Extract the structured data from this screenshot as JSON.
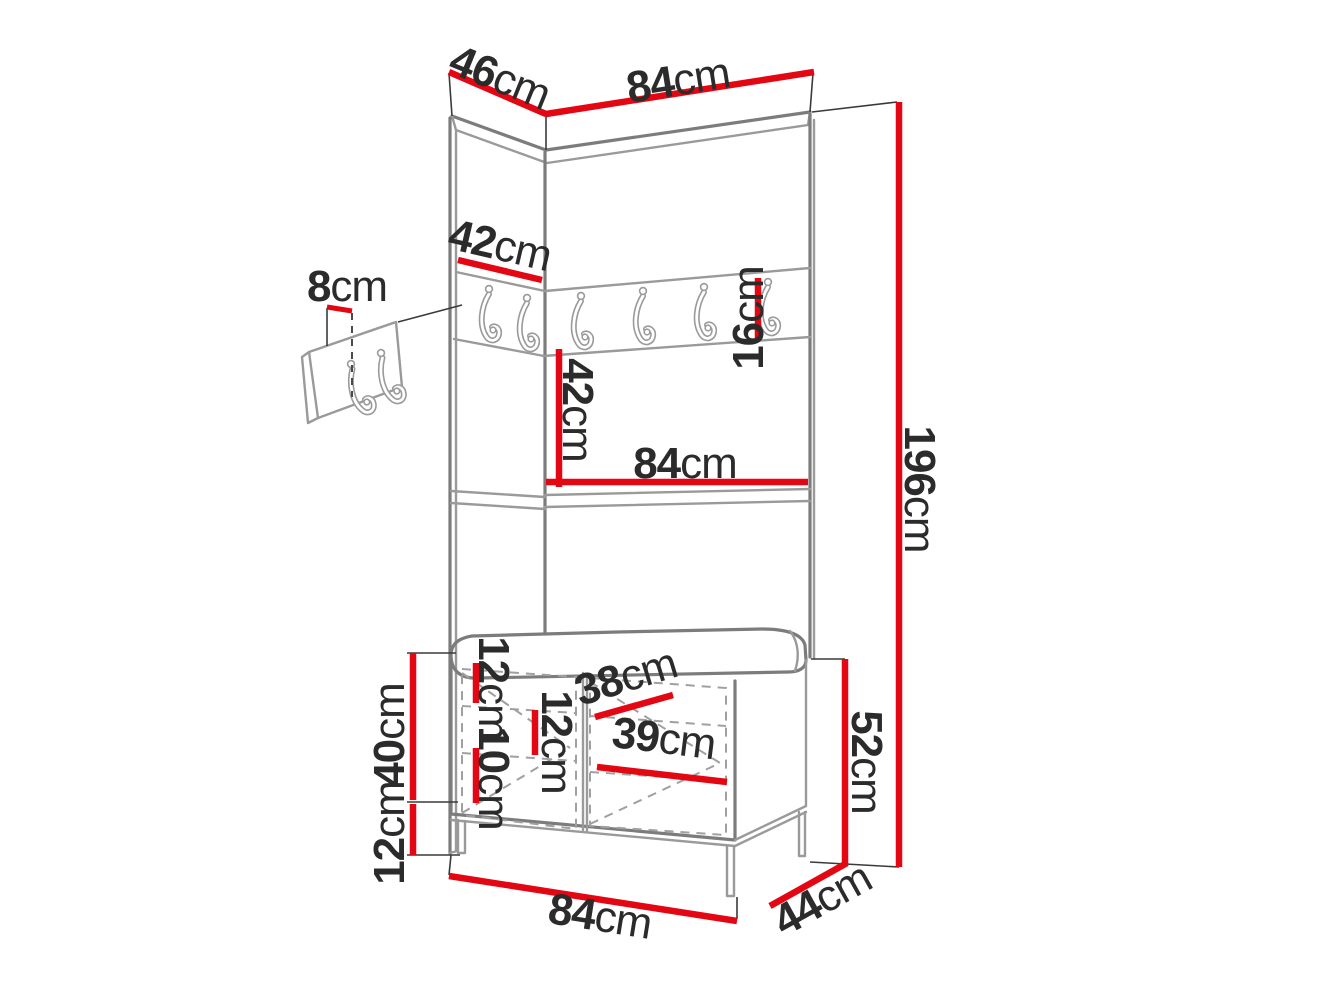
{
  "title": "Hallway furniture set dimension diagram",
  "colors": {
    "dimension_line": "#e30613",
    "outline": "#9a9a9a",
    "label_text": "#2b2b2b",
    "background": "#ffffff"
  },
  "unit": "cm",
  "dims": {
    "top_side_depth": {
      "value": "46",
      "unit": "cm"
    },
    "top_front_width": {
      "value": "84",
      "unit": "cm"
    },
    "left_panel_width": {
      "value": "42",
      "unit": "cm"
    },
    "hook_panel_offset": {
      "value": "8",
      "unit": "cm"
    },
    "hook_rail_height": {
      "value": "16",
      "unit": "cm"
    },
    "hooks_to_shelf": {
      "value": "42",
      "unit": "cm"
    },
    "shelf_width": {
      "value": "84",
      "unit": "cm"
    },
    "total_height": {
      "value": "196",
      "unit": "cm"
    },
    "bench_top_gap": {
      "value": "12",
      "unit": "cm"
    },
    "bench_upper_depth": {
      "value": "38",
      "unit": "cm"
    },
    "bench_mid_gap": {
      "value": "12",
      "unit": "cm"
    },
    "bench_lower_gap": {
      "value": "10",
      "unit": "cm"
    },
    "bench_inner_width": {
      "value": "39",
      "unit": "cm"
    },
    "bench_body_height": {
      "value": "40",
      "unit": "cm"
    },
    "bench_leg_height": {
      "value": "12",
      "unit": "cm"
    },
    "bench_total_height": {
      "value": "52",
      "unit": "cm"
    },
    "bench_width": {
      "value": "84",
      "unit": "cm"
    },
    "bench_depth": {
      "value": "44",
      "unit": "cm"
    }
  }
}
